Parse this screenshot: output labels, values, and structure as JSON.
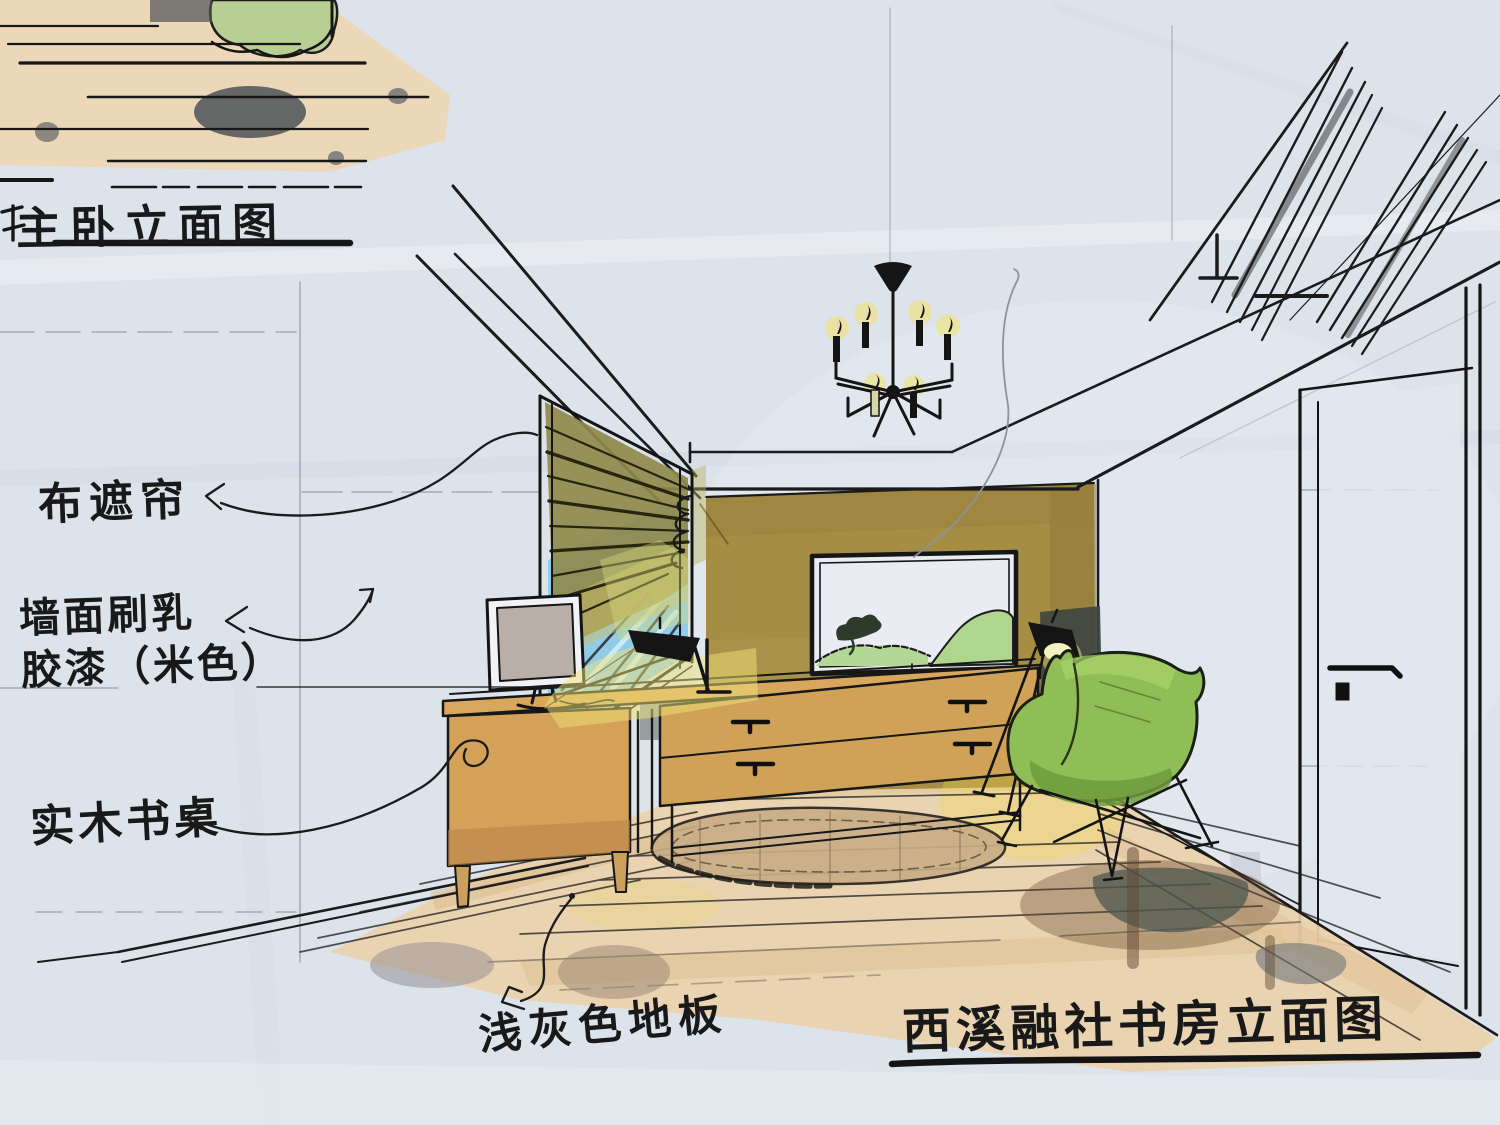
{
  "sheet": {
    "background": "#dde3eb",
    "ink": "#1b1b1b",
    "pencil": "#98a0ab"
  },
  "fragment_title": {
    "text": "主卧立面图"
  },
  "annotations": {
    "curtain": {
      "text": "布遮帘"
    },
    "wall_paint_line1": {
      "text": "墙面刷乳"
    },
    "wall_paint_line2": {
      "text": "胶漆（米色）"
    },
    "desk": {
      "text": "实木书桌"
    },
    "floor": {
      "text": "浅灰色地板"
    }
  },
  "main_title": {
    "text": "西溪融社书房立面图"
  },
  "palette": {
    "accent_wall": "#a68d44",
    "floor_wood": "#ead1ab",
    "window_glass": "#87c8e8",
    "blind_olive": "#8f8a4c",
    "desk_wood": "#d2a55c",
    "chair_green": "#8fbe57",
    "lamp_glow": "#efe37a",
    "shadow_gray": "#565b55"
  }
}
